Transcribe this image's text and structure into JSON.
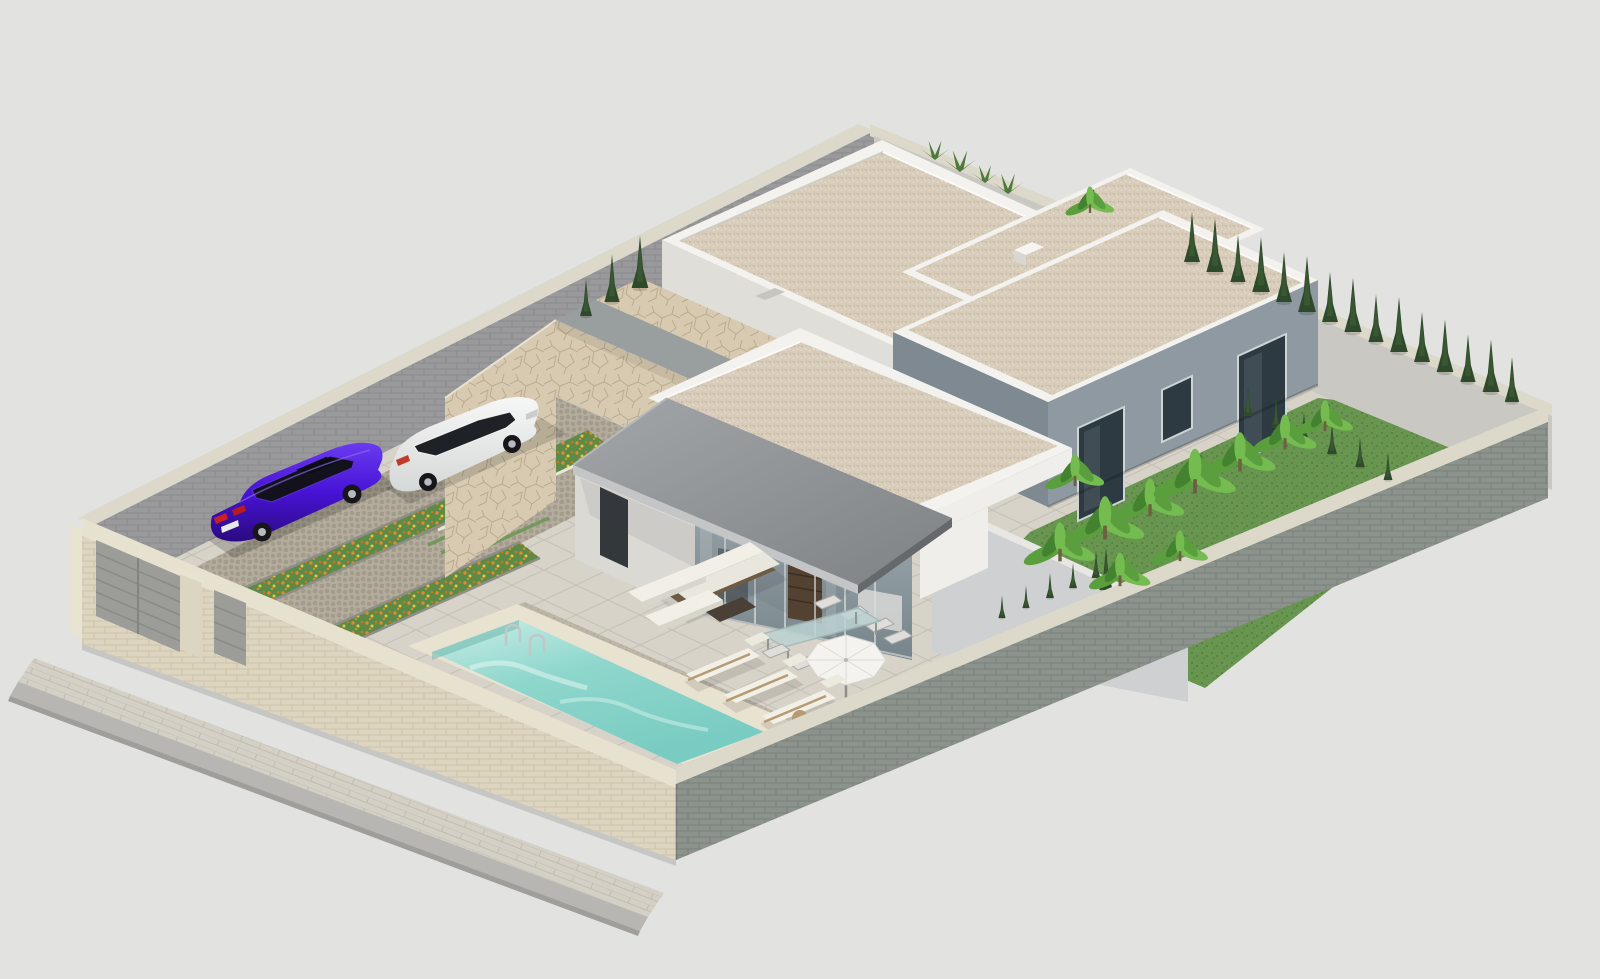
{
  "scene": {
    "title": "isometric-3d-render-modern-villa-plot",
    "view": "aerial isometric",
    "description": "Photorealistic CGI rendering of a walled villa plot with flat-roof white buildings, a gray-walled house, a stone-clad entrance volume with cantilevered canopy, glazed terrace wall, raised turquoise swimming pool, cobbled driveway with two parked cars, flower beds, lawn garden with banana plants and cypress trees",
    "counts": {
      "buildings": 4,
      "cars": 2,
      "wooden-sun-loungers": 3,
      "white-daybeds": 2,
      "dining-chairs": 6,
      "parasols": 1,
      "gates": 2,
      "pool-ladders": 1
    }
  },
  "objects": {
    "vehicles": [
      {
        "id": "sedan",
        "color-name": "purple"
      },
      {
        "id": "suv",
        "color-name": "white"
      }
    ],
    "pool": {
      "shape": "rectangular",
      "water": "turquoise",
      "ladder": "stainless steel"
    },
    "landscaping": [
      "banana plants",
      "cypress hedge rows",
      "orange-yellow flower strips",
      "lawn"
    ],
    "perimeter": [
      "cream brick wall with metal gates",
      "gray block walls"
    ]
  },
  "colors": {
    "bg": "#e2e2e1",
    "coping": "#dcd9cb",
    "coping-cream": "#e7e1cf",
    "brick-cream-base": "#ddd5bf",
    "brick-cream-line": "#ccc3ab",
    "brick-gray-base": "#9a9a9c",
    "brick-gray-line": "#8a8a8c",
    "brick-gray2-base": "#8c928c",
    "brick-gray2-line": "#7a807a",
    "wall-inner-light": "#c9c8c2",
    "roof-gravel": "#d8ccba",
    "gravel-dot1": "#c5b29b",
    "gravel-dot2": "#ece4d6",
    "parapet": "#f3f2ee",
    "wall-white": "#efeeea",
    "wall-white-shade": "#e0ded8",
    "wall-c": "#8e99a2",
    "wall-c-shade": "#7e8992",
    "side-wing": "#cfd0d1",
    "canopy-fascia": "#c3c5c6",
    "canopy-dark": "#66696c",
    "mullion": "#d8dcdc",
    "wood-dark": "#55422f",
    "stone-base": "#d7cab1",
    "stone-line": "#b3a488",
    "channel": "#999e9e",
    "slab-base": "#d7d3c8",
    "slab-line": "#c6c2b7",
    "cobble-base": "#b4ad9e",
    "cobble-dot": "#a39c8c",
    "speckle-base": "#bcb6a8",
    "speckle-dot": "#aaa494",
    "paver-base": "#d4d0c5",
    "paver-line": "#c0bcb1",
    "curb": "#b7b6b2",
    "grass-base": "#68954f",
    "grass-dot": "#527e3b",
    "flower-green": "#5d8a46",
    "flower-orange": "#e08a2e",
    "flower-orange2": "#d1751f",
    "flower-yellow": "#e5c83e",
    "pool-coping": "#e8e2d1",
    "water-1": "#c9eee7",
    "water-2": "#8ed6cc",
    "water-3": "#79ccc2",
    "cypress": "#2f4a2b",
    "cypress-hi": "#44623a",
    "banana-1": "#5a9e3e",
    "banana-2": "#74bc50",
    "banana-3": "#43822e",
    "cushion": "#f1efe6",
    "wood": "#b59a72",
    "wicker": "#6d5b44",
    "gate": "#9c9c98",
    "umbrella": "#f4f3ef",
    "car-purple-hi": "#6a3bf0",
    "car-purple": "#4813d6",
    "car-purple-dark": "#2a0a80",
    "car-white": "#ecedeb"
  }
}
